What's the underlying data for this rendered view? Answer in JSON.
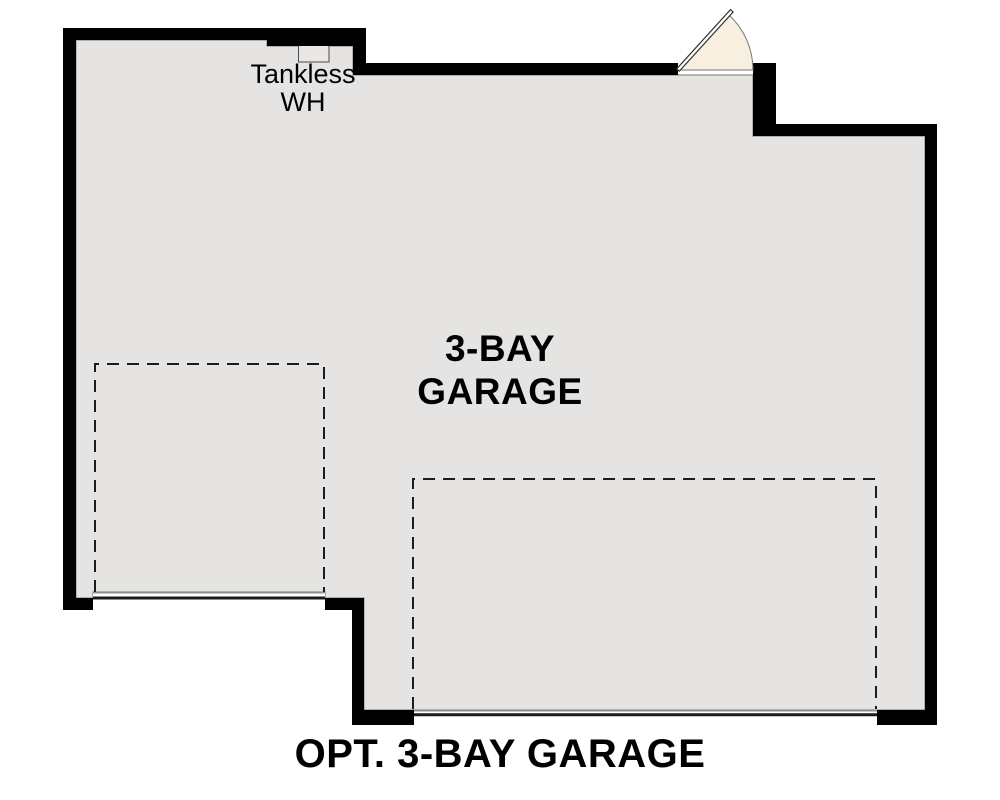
{
  "plan": {
    "caption": "OPT. 3-BAY GARAGE",
    "room": {
      "name": "3-BAY GARAGE",
      "label_line1": "3-BAY",
      "label_line2": "GARAGE"
    },
    "fixtures": {
      "water_heater": {
        "name": "Tankless WH",
        "label_line1": "Tankless",
        "label_line2": "WH"
      },
      "entry_door": {
        "type": "swing-door",
        "location": "top wall"
      },
      "garage_doors": [
        {
          "location": "bottom-left bay"
        },
        {
          "location": "bottom main double bay"
        }
      ],
      "parking_bays_dashed": [
        {
          "location": "left single bay"
        },
        {
          "location": "right double bay"
        }
      ]
    }
  },
  "colors": {
    "wall": "#000000",
    "floor": "#e5e4e2",
    "hairline": "#8f8f8f",
    "dashed_line": "#1c1c1c",
    "door_swing_fill": "#f7efe0",
    "text": "#000000",
    "background": "#ffffff"
  }
}
